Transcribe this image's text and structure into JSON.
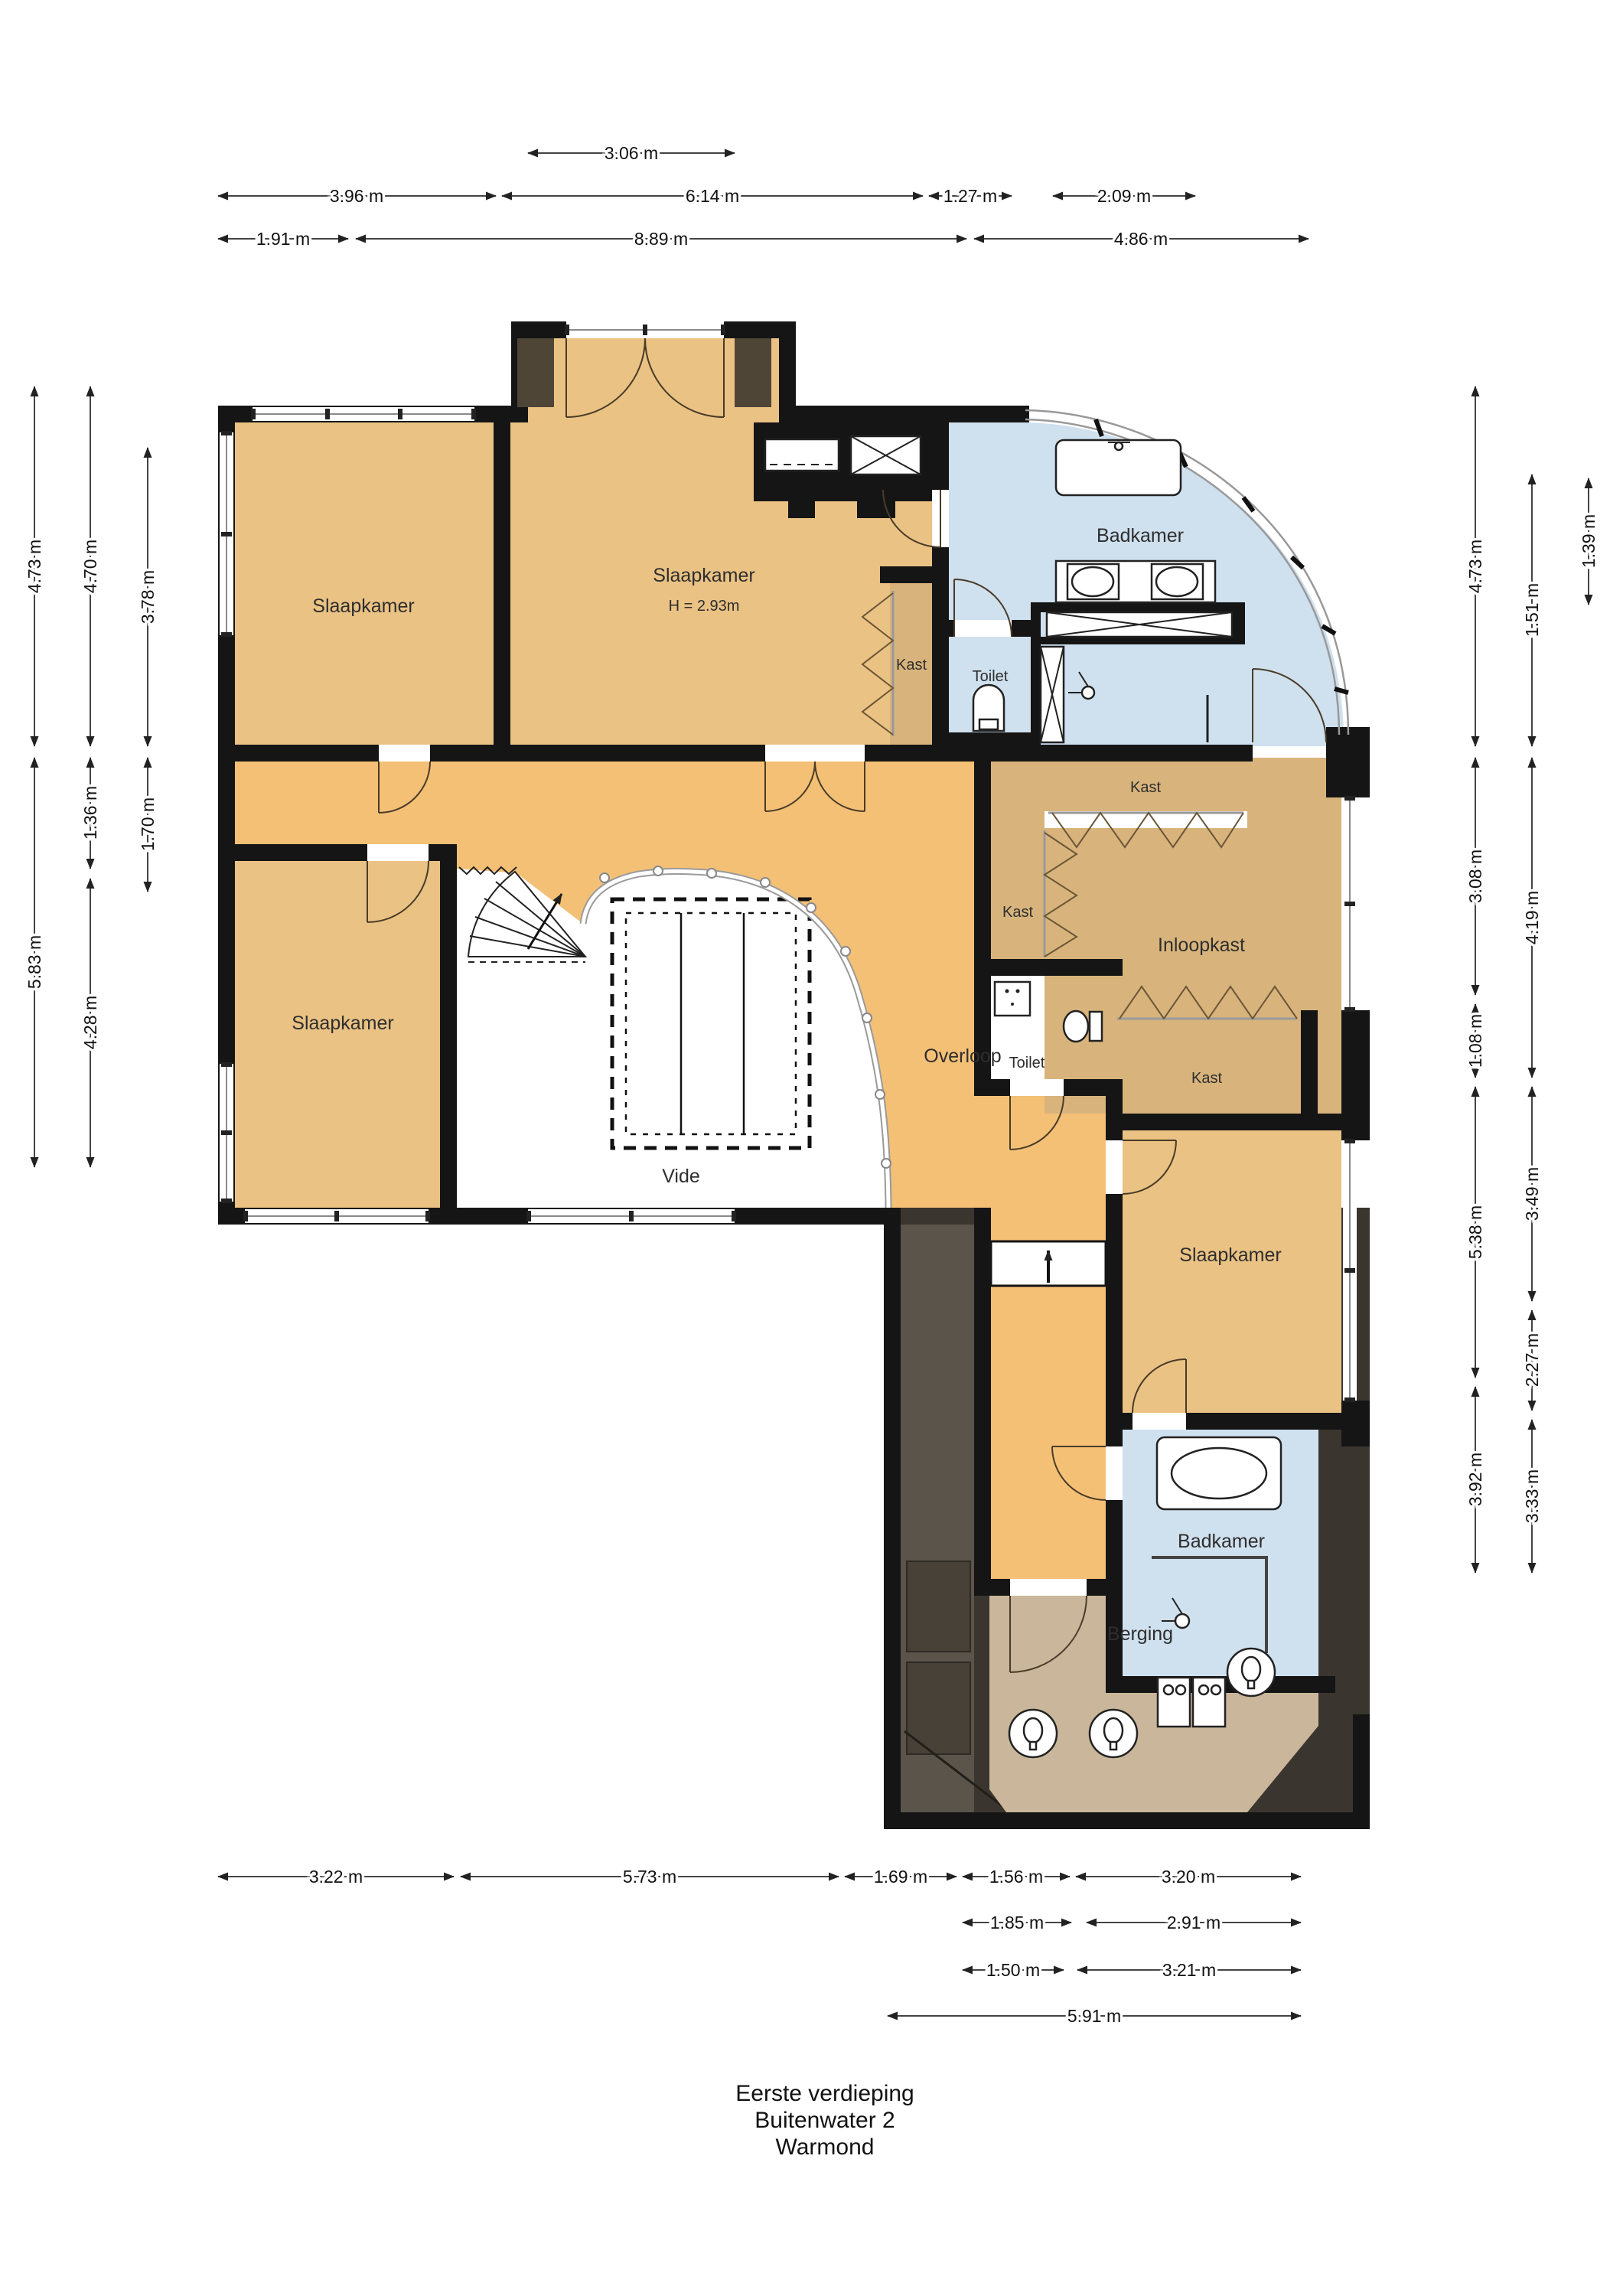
{
  "title": {
    "lines": [
      "Eerste verdieping",
      "Buitenwater 2",
      "Warmond"
    ]
  },
  "rooms": {
    "bedroom_top_left": "Slaapkamer",
    "bedroom_top_middle": "Slaapkamer",
    "bedroom_height_note": "H = 2.93m",
    "bathroom_top": "Badkamer",
    "toilet_top": "Toilet",
    "closet_small": "Kast",
    "closet_strip": "Kast",
    "closet_left": "Kast",
    "walk_in_closet": "Inloopkast",
    "closet_bottom": "Kast",
    "toilet_mid": "Toilet",
    "bedroom_mid_left": "Slaapkamer",
    "landing": "Overloop",
    "void": "Vide",
    "bedroom_bottom_right": "Slaapkamer",
    "bathroom_bottom": "Badkamer",
    "storage": "Berging"
  },
  "dims": {
    "top1": [
      "3.06 m"
    ],
    "top2": [
      "3.96 m",
      "6.14 m",
      "1.27 m",
      "2.09 m"
    ],
    "top3": [
      "1.91 m",
      "8.89 m",
      "4.86 m"
    ],
    "bottom1": [
      "3.22 m",
      "5.73 m",
      "1.69 m",
      "1.56 m",
      "3.20 m"
    ],
    "bottom2": [
      "1.85 m",
      "2.91 m"
    ],
    "bottom3": [
      "1.50 m",
      "3.21 m"
    ],
    "bottom4": [
      "5.91 m"
    ],
    "left1": [
      "4.73 m",
      "5.83 m"
    ],
    "left2": [
      "4.70 m",
      "1.36 m",
      "4.28 m"
    ],
    "left3": [
      "3.78 m",
      "1.70 m"
    ],
    "right_inner": [
      "4.73 m",
      "3.08 m",
      "1.08 m",
      "5.38 m",
      "3.92 m"
    ],
    "right_mid": [
      "1.51 m",
      "4.19 m",
      "3.49 m",
      "2.27 m",
      "3.33 m"
    ],
    "right_outer": [
      "1.39 m"
    ]
  },
  "colors": {
    "wall": "#151515",
    "floor_room": "#eac284",
    "floor_landing": "#f4c076",
    "floor_closet": "#d8b47c",
    "floor_bath": "#cfe0ee",
    "floor_storage": "#c9b69b",
    "roof_dark": "#3a352e",
    "roof_panel": "#5a544a",
    "window_line": "#8a8a8a"
  }
}
